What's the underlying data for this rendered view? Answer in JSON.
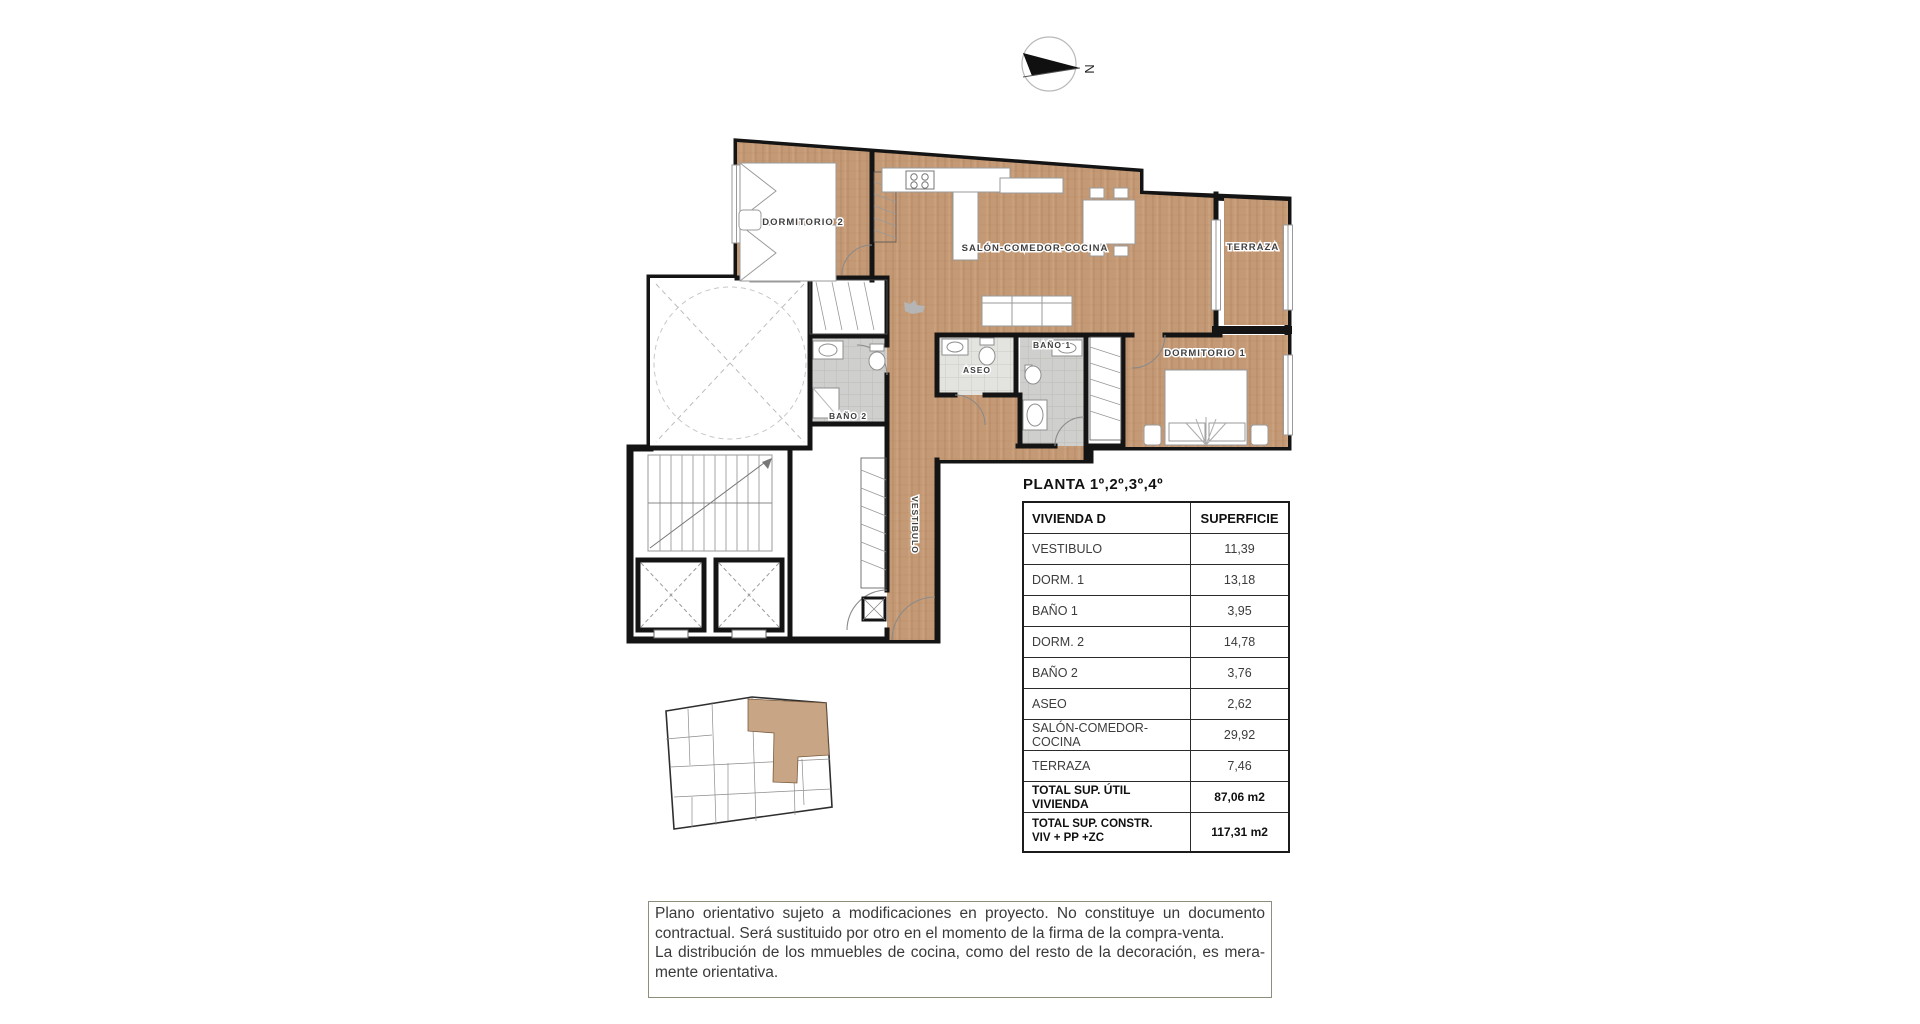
{
  "compass": {
    "north_label": "N"
  },
  "plan": {
    "rooms": {
      "dormitorio2": "DORMITORIO 2",
      "salon": "SALÓN-COMEDOR-COCINA",
      "terraza": "TERRAZA",
      "bano1": "BAÑO 1",
      "aseo": "ASEO",
      "dormitorio1": "DORMITORIO 1",
      "bano2": "BAÑO 2",
      "vestibulo": "VESTIBULO"
    },
    "colors": {
      "wood": "#c49a76",
      "wood_grain": "#b0835c",
      "wall": "#141414",
      "tile_light": "#e3e3e0",
      "tile_dark": "#cfcfcd",
      "keyplan_highlight": "#c8a584"
    }
  },
  "table": {
    "title": "PLANTA 1º,2º,3º,4º",
    "columns": [
      "VIVIENDA D",
      "SUPERFICIE"
    ],
    "rows": [
      {
        "label": "VESTIBULO",
        "value": "11,39"
      },
      {
        "label": "DORM. 1",
        "value": "13,18"
      },
      {
        "label": "BAÑO 1",
        "value": "3,95"
      },
      {
        "label": "DORM. 2",
        "value": "14,78"
      },
      {
        "label": "BAÑO 2",
        "value": "3,76"
      },
      {
        "label": "ASEO",
        "value": "2,62"
      },
      {
        "label": "SALÓN-COMEDOR-COCINA",
        "value": "29,92"
      },
      {
        "label": "TERRAZA",
        "value": "7,46"
      }
    ],
    "totals": [
      {
        "label_lines": [
          "TOTAL SUP. ÚTIL VIVIENDA",
          ""
        ],
        "value": "87,06 m2"
      },
      {
        "label_lines": [
          "TOTAL SUP. CONSTR.",
          "VIV + PP +ZC"
        ],
        "value": "117,31 m2"
      }
    ]
  },
  "disclaimer": {
    "text": "Plano orientativo sujeto a modificaciones en proyecto. No constituye un documento contractual. Será sustituido por otro en el momento de la firma de la compra-venta.\nLa distribución de los mmuebles de cocina, como del resto de la decoración, es mera-mente orientativa."
  }
}
